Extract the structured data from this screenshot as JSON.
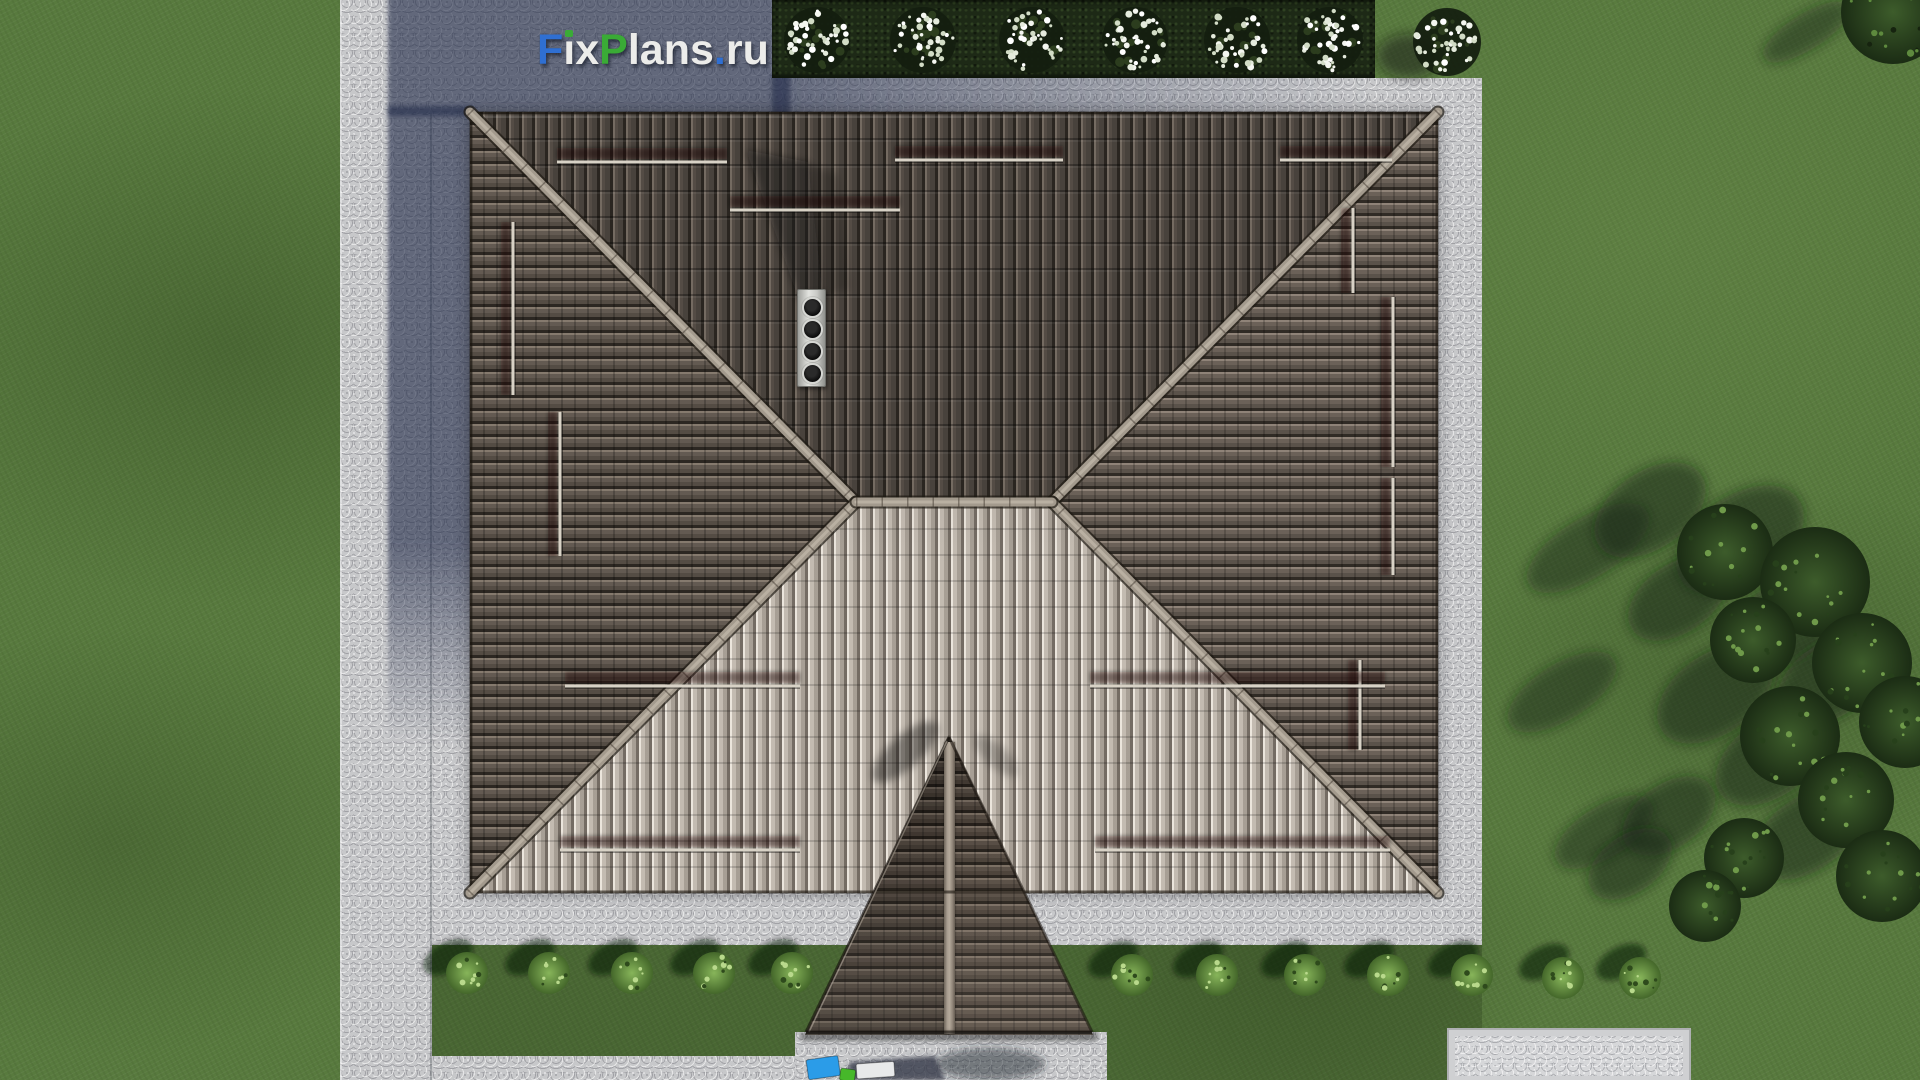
{
  "watermark": {
    "text": "FixPlans.ru",
    "segments": [
      {
        "t": "F",
        "c": "#2f6fd2"
      },
      {
        "t": "ı",
        "c": "#ececea",
        "dot": "#3aab36"
      },
      {
        "t": "x",
        "c": "#ececea"
      },
      {
        "t": "P",
        "c": "#3aab36"
      },
      {
        "t": "lans",
        "c": "#ececea"
      },
      {
        "t": ".",
        "c": "#2f6fd2"
      },
      {
        "t": "ru",
        "c": "#ececea"
      }
    ]
  },
  "palette": {
    "accent_blue": "#2f6fd2",
    "accent_green": "#3aab36",
    "grass": "#587a3e",
    "pavement": "#c7c8ca",
    "building_shadow": "#343d55",
    "hedge": "#1d2916",
    "roof_dark_tiles": "#544c45",
    "roof_light_tiles": "#b4aba1",
    "roof_side_tiles": "#5f564e",
    "ridge_cap": "#a39a8d",
    "chimney_cap": "#e3e4e0"
  },
  "scene": {
    "hedge_trees": {
      "y": 40,
      "r": 33,
      "xs": [
        817,
        923,
        1032,
        1135,
        1237,
        1330
      ]
    },
    "flower_tree": {
      "x": 1447,
      "y": 42,
      "r": 34
    },
    "corner_foliage": {
      "x": 1893,
      "y": 12,
      "r": 52
    },
    "bush_row": {
      "r": 21,
      "items": [
        [
          467,
          973
        ],
        [
          549,
          973
        ],
        [
          632,
          973
        ],
        [
          714,
          973
        ],
        [
          792,
          973
        ],
        [
          1132,
          975
        ],
        [
          1217,
          975
        ],
        [
          1305,
          975
        ],
        [
          1388,
          975
        ],
        [
          1472,
          975
        ],
        [
          1563,
          978
        ],
        [
          1640,
          978
        ]
      ]
    },
    "conifers": [
      [
        1725,
        552,
        48
      ],
      [
        1815,
        582,
        55
      ],
      [
        1753,
        640,
        43
      ],
      [
        1862,
        663,
        50
      ],
      [
        1905,
        722,
        46
      ],
      [
        1790,
        736,
        50
      ],
      [
        1846,
        800,
        48
      ],
      [
        1744,
        858,
        40
      ],
      [
        1882,
        876,
        46
      ],
      [
        1705,
        906,
        36
      ]
    ],
    "shadow_streaks": [
      [
        1588,
        548,
        70,
        30
      ],
      [
        1562,
        692,
        62,
        28
      ],
      [
        1604,
        832,
        56,
        26
      ],
      [
        1806,
        32,
        50,
        18
      ]
    ],
    "snow_rails": [
      {
        "o": "h",
        "c": 162,
        "a": 557,
        "b": 727
      },
      {
        "o": "h",
        "c": 210,
        "a": 730,
        "b": 900
      },
      {
        "o": "h",
        "c": 160,
        "a": 895,
        "b": 1063
      },
      {
        "o": "h",
        "c": 160,
        "a": 1280,
        "b": 1392
      },
      {
        "o": "v",
        "c": 513,
        "a": 222,
        "b": 395
      },
      {
        "o": "v",
        "c": 560,
        "a": 412,
        "b": 556
      },
      {
        "o": "v",
        "c": 1353,
        "a": 208,
        "b": 293
      },
      {
        "o": "v",
        "c": 1393,
        "a": 297,
        "b": 467
      },
      {
        "o": "v",
        "c": 1393,
        "a": 478,
        "b": 575
      },
      {
        "o": "v",
        "c": 1360,
        "a": 660,
        "b": 750
      },
      {
        "o": "h",
        "c": 686,
        "a": 565,
        "b": 800
      },
      {
        "o": "h",
        "c": 686,
        "a": 1090,
        "b": 1385
      },
      {
        "o": "h",
        "c": 850,
        "a": 560,
        "b": 800
      },
      {
        "o": "h",
        "c": 850,
        "a": 1095,
        "b": 1390
      }
    ],
    "chimney": {
      "vents": 4
    },
    "entry_objects": {
      "blue": [
        806,
        1060,
        32,
        20,
        -8,
        "#2b9ce8"
      ],
      "green": [
        841,
        1068,
        15,
        12,
        8,
        "#46b82a"
      ],
      "white": [
        856,
        1064,
        38,
        15,
        -4,
        "#e8e9ea"
      ]
    },
    "roof": {
      "x": 470,
      "y": 112,
      "w": 968,
      "h": 781,
      "ridge_y": 502,
      "ridge_x1": 856,
      "ridge_x2": 1052,
      "porch": {
        "apex_x": 949,
        "apex_y": 737,
        "base_y": 1032,
        "left_x": 806,
        "right_x": 1092
      }
    }
  }
}
